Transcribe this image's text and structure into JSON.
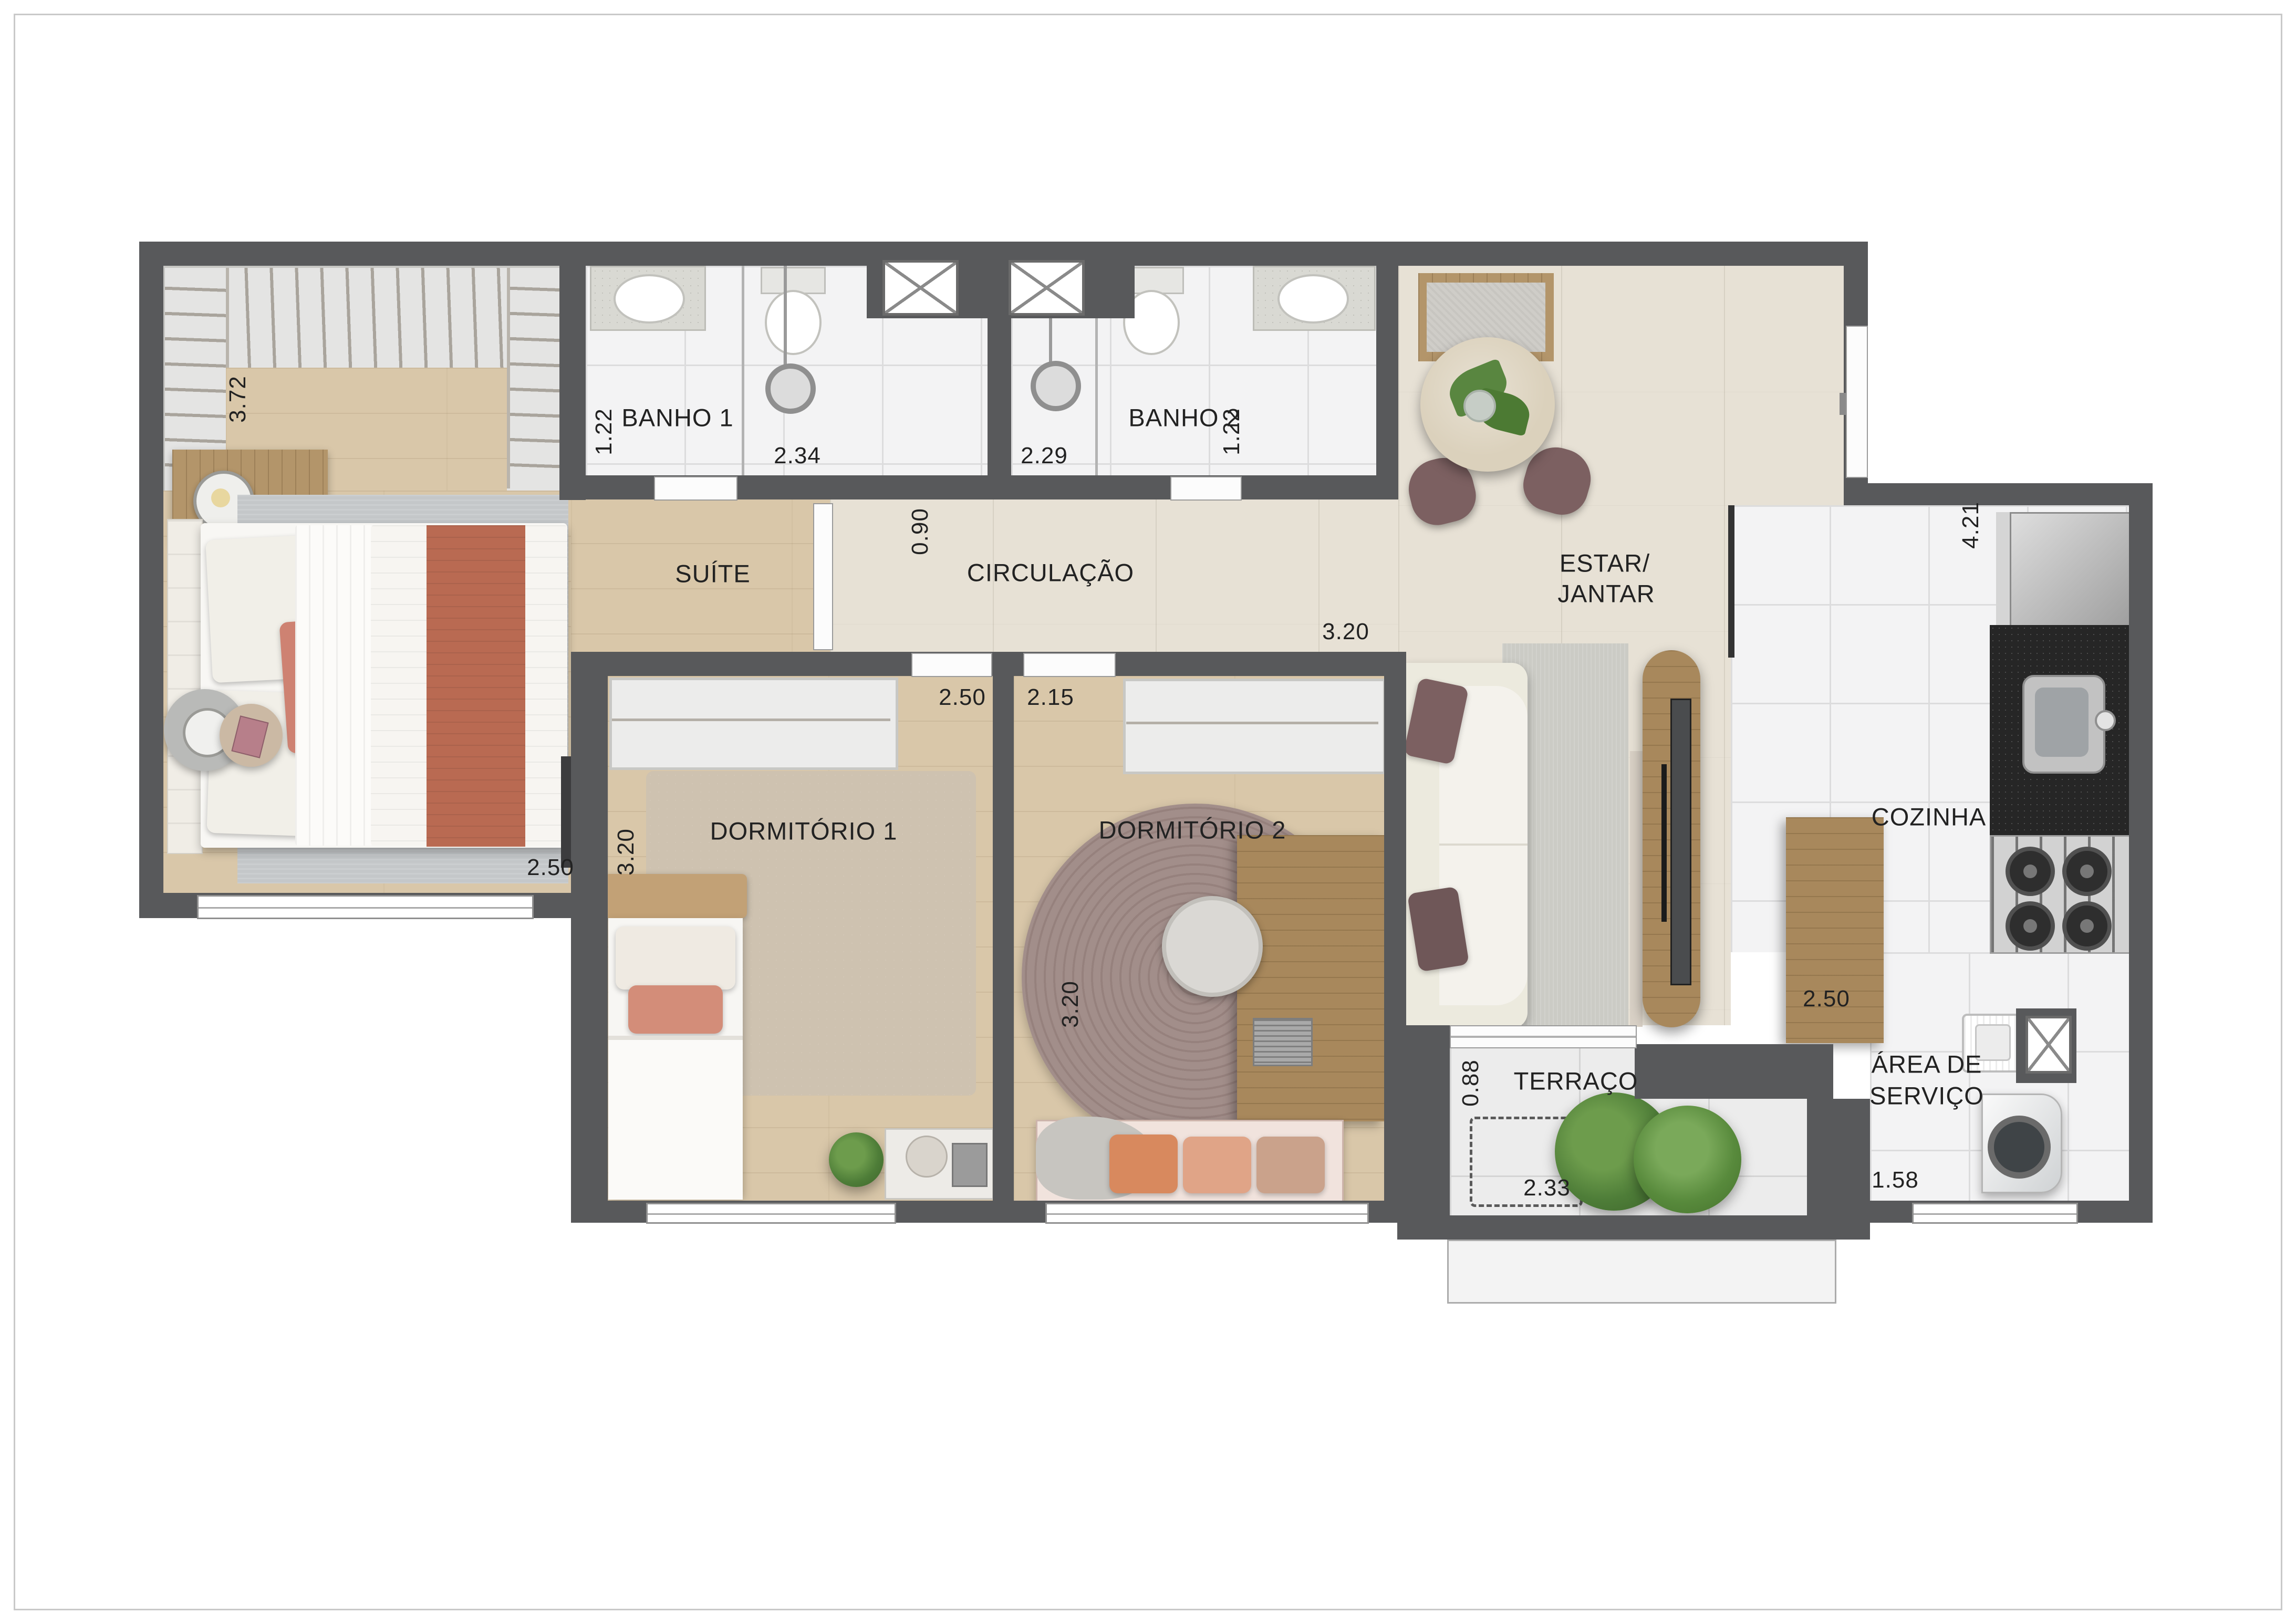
{
  "plan": {
    "type": "apartment-floor-plan",
    "language": "pt-BR",
    "rooms": {
      "suite": {
        "label": "SUÍTE",
        "dim_closet": "3.72",
        "dim_width": "2.50"
      },
      "banho1": {
        "label": "BANHO 1",
        "dim_depth": "1.22",
        "dim_length": "2.34"
      },
      "banho2": {
        "label": "BANHO 2",
        "dim_length": "2.29",
        "dim_depth": "1.22"
      },
      "circulacao": {
        "label": "CIRCULAÇÃO",
        "dim_width": "0.90",
        "dim_length": "3.20"
      },
      "estar_jantar": {
        "label_line1": "ESTAR/",
        "label_line2": "JANTAR",
        "dim_cabinet": "2.50"
      },
      "cozinha": {
        "label": "COZINHA",
        "dim_length": "4.21"
      },
      "dormitorio1": {
        "label": "DORMITÓRIO 1",
        "dim_width": "2.50",
        "dim_length": "3.20"
      },
      "dormitorio2": {
        "label": "DORMITÓRIO 2",
        "dim_width": "2.15",
        "dim_length": "3.20"
      },
      "terraco": {
        "label": "TERRAÇO",
        "dim_depth": "0.88",
        "dim_length": "2.33"
      },
      "area_servico": {
        "label_line1": "ÁREA DE",
        "label_line2": "SERVIÇO",
        "dim_width": "1.58"
      }
    },
    "colors": {
      "wall": "#58595b",
      "bedroom_wood_floor": "#d9c7a9",
      "living_floor": "#e7e1d5",
      "wet_area_tile": "#f3f3f4",
      "terrace_tile": "#ececec",
      "furniture_wood": "#b3956a",
      "counter_dark": "#262626",
      "mauve_accent": "#7c6061",
      "terracotta_accent": "#b96a52"
    }
  }
}
